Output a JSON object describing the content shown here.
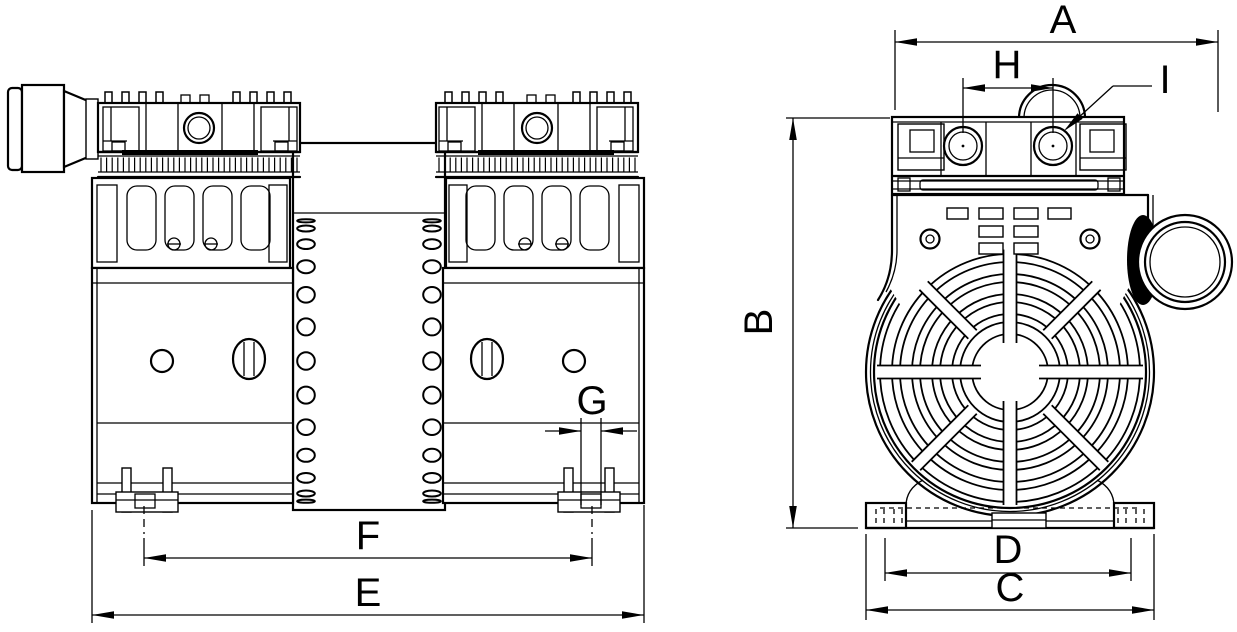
{
  "page": {
    "background_color": "#ffffff",
    "line_color": "#000000",
    "type": "technical-dimension-drawing"
  },
  "views": {
    "side_view": "twin-head pump side elevation",
    "front_view": "pump front elevation with fan cover"
  },
  "dimension_labels": {
    "A": "A",
    "B": "B",
    "C": "C",
    "D": "D",
    "E": "E",
    "F": "F",
    "G": "G",
    "H": "H",
    "I": "I"
  }
}
